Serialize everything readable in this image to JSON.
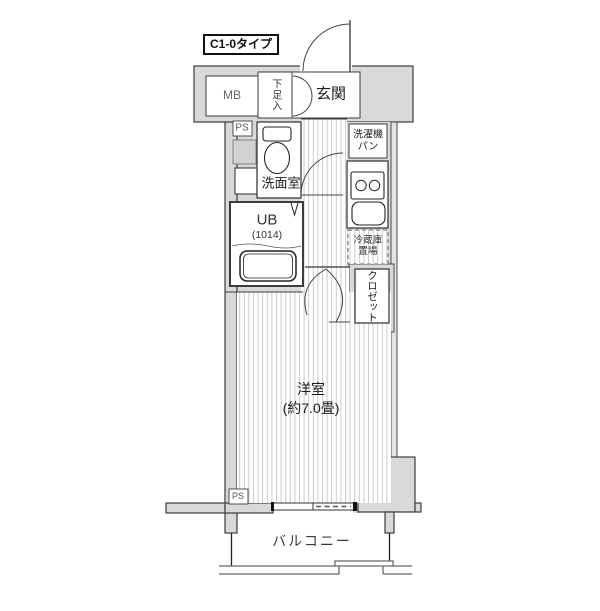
{
  "floorplan": {
    "title_badge": "C1-0タイプ",
    "labels": {
      "mb": "MB",
      "shoe_cabinet": "下足入",
      "entrance": "玄関",
      "pipe_space_top": "PS",
      "washroom": "洗面室",
      "unit_bath": "UB",
      "unit_bath_size": "(1014)",
      "washer_pan_line1": "洗濯機",
      "washer_pan_line2": "パン",
      "fridge_line1": "冷蔵庫",
      "fridge_line2": "置場",
      "closet": "クロゼット",
      "western_room": "洋室",
      "western_room_size": "(約7.0畳)",
      "pipe_space_bottom": "PS",
      "balcony": "バルコニー"
    },
    "colors": {
      "wall_fill": "#d9d9d9",
      "outline": "#3c3c3c",
      "floor_stripe": "#cccccc",
      "background": "#ffffff"
    }
  }
}
